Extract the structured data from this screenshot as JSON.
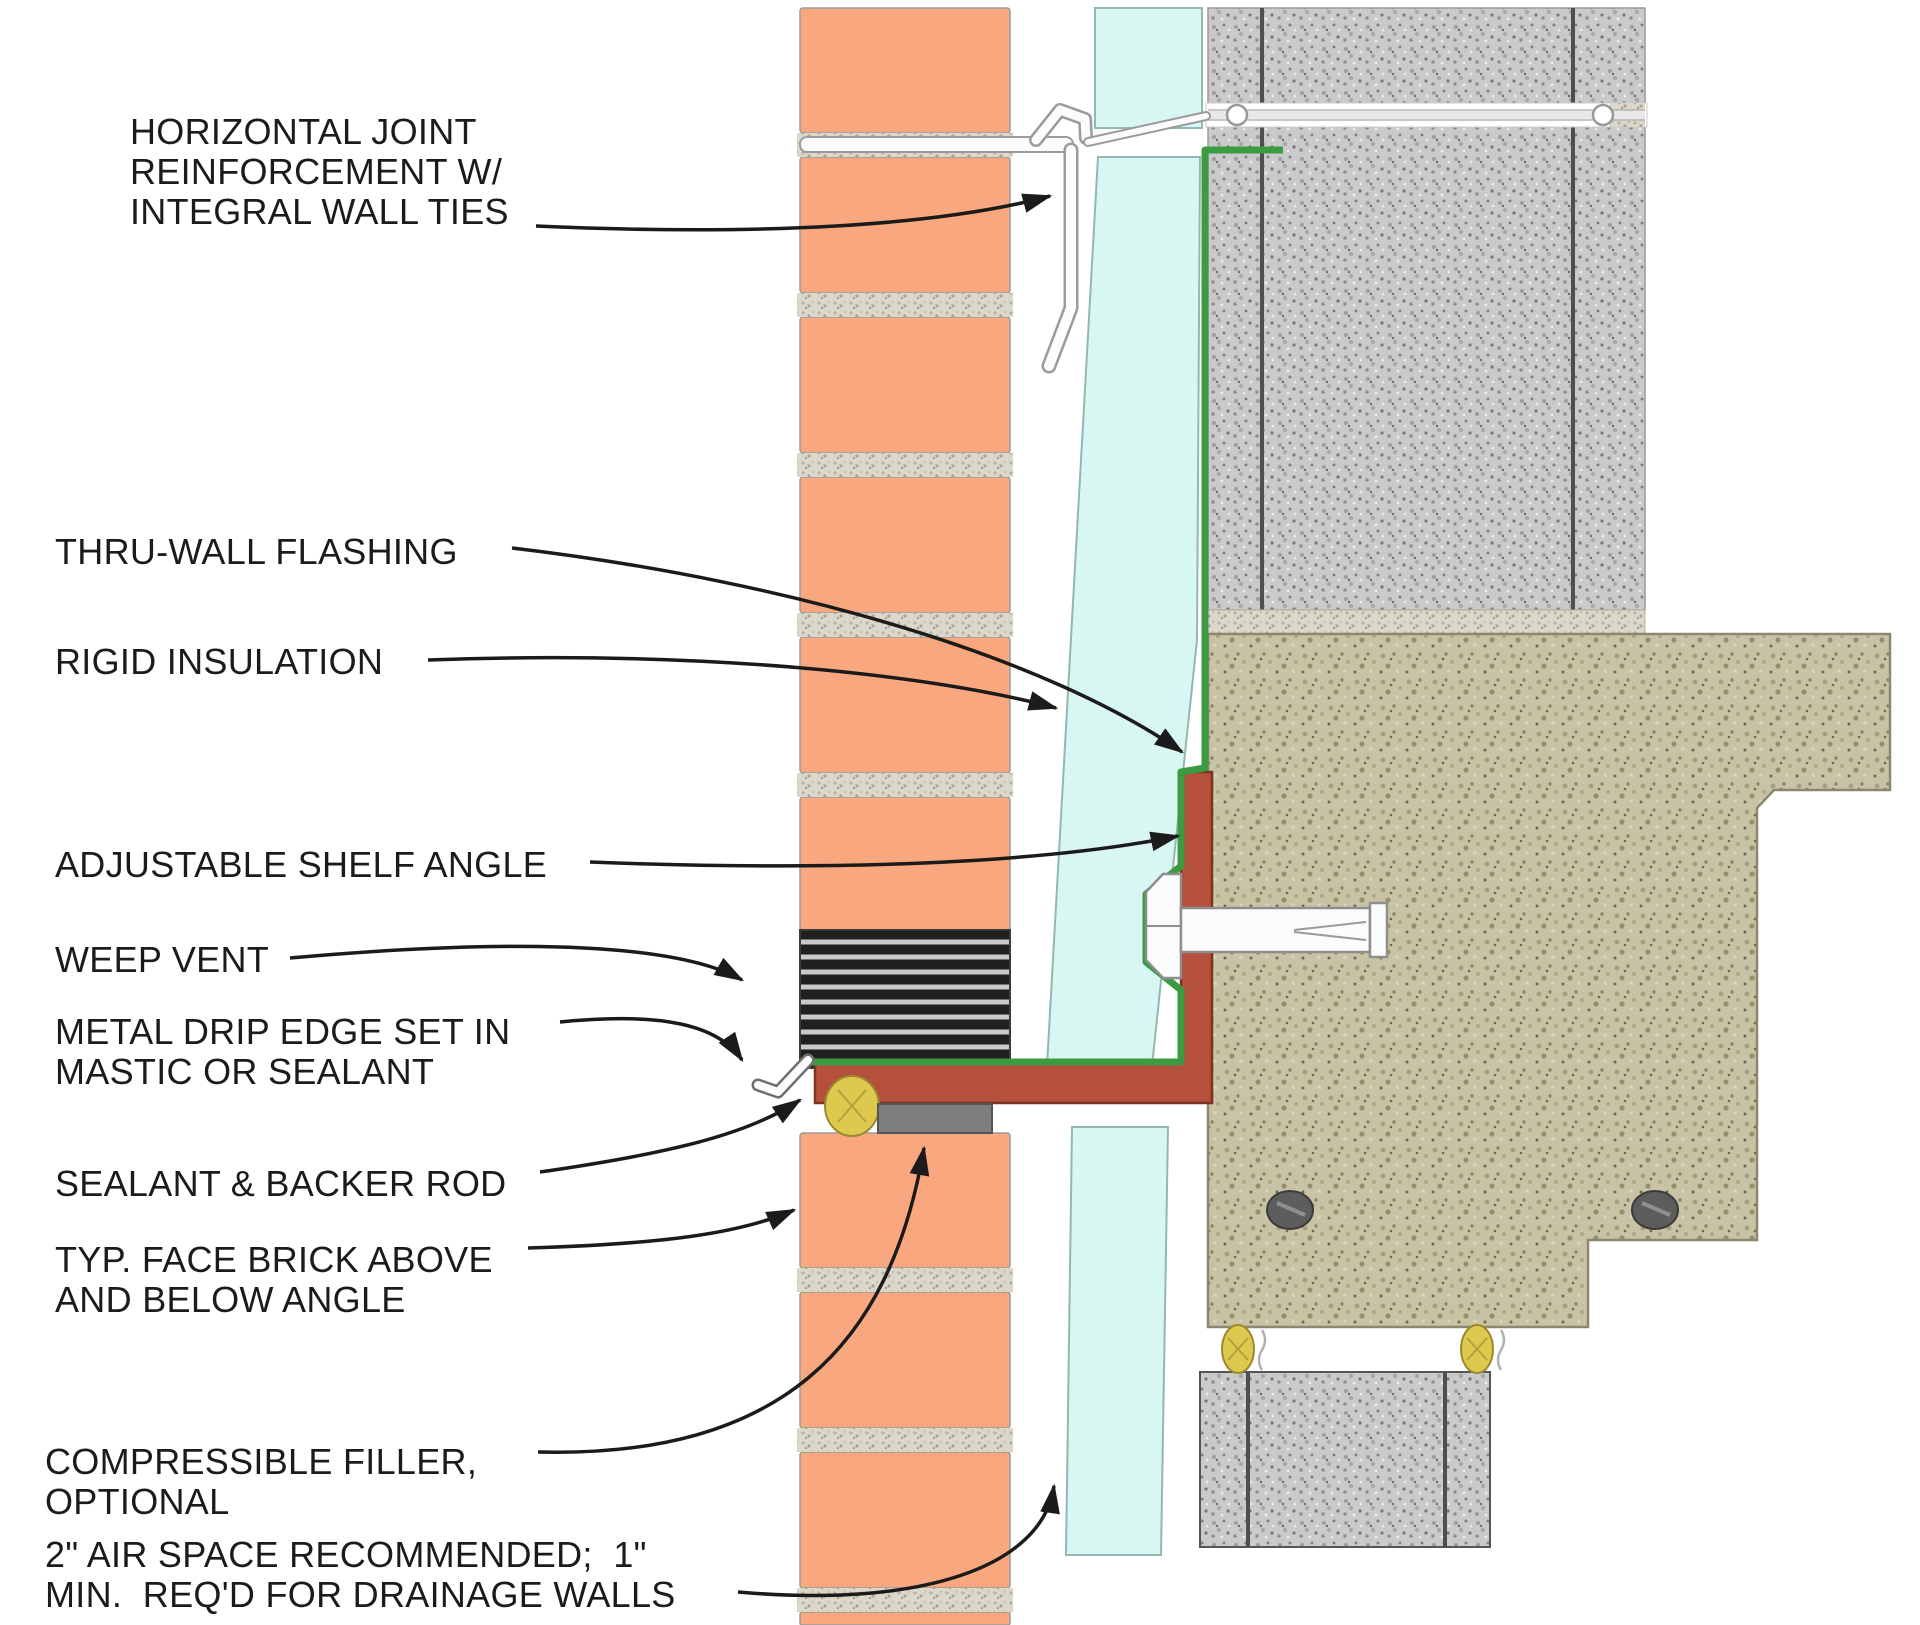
{
  "diagram": {
    "type": "architectural-detail-section",
    "subject": "Brick veneer shelf angle at concrete slab - wall section detail",
    "labels": [
      {
        "id": "horizontal-joint-reinforcement",
        "lines": [
          "HORIZONTAL JOINT",
          "REINFORCEMENT W/",
          "INTEGRAL WALL TIES"
        ]
      },
      {
        "id": "thru-wall-flashing",
        "lines": [
          "THRU-WALL FLASHING"
        ]
      },
      {
        "id": "rigid-insulation",
        "lines": [
          "RIGID INSULATION"
        ]
      },
      {
        "id": "adjustable-shelf-angle",
        "lines": [
          "ADJUSTABLE SHELF ANGLE"
        ]
      },
      {
        "id": "weep-vent",
        "lines": [
          "WEEP VENT"
        ]
      },
      {
        "id": "metal-drip-edge",
        "lines": [
          "METAL DRIP EDGE SET IN",
          "MASTIC OR SEALANT"
        ]
      },
      {
        "id": "sealant-backer-rod",
        "lines": [
          "SEALANT & BACKER ROD"
        ]
      },
      {
        "id": "typ-face-brick",
        "lines": [
          "TYP. FACE BRICK ABOVE",
          "AND BELOW ANGLE"
        ]
      },
      {
        "id": "compressible-filler",
        "lines": [
          "COMPRESSIBLE FILLER,",
          "OPTIONAL"
        ]
      },
      {
        "id": "air-space-note",
        "lines": [
          "2\" AIR SPACE RECOMMENDED;  1\"",
          "MIN.  REQ'D FOR DRAINAGE WALLS"
        ]
      }
    ],
    "materials": {
      "face_brick": {
        "name": "face brick",
        "color": "#F8A77E"
      },
      "mortar": {
        "name": "mortar joint",
        "color": "#DBD7CB"
      },
      "rigid_insulation": {
        "name": "rigid insulation",
        "color": "#D8F7F3"
      },
      "flashing": {
        "name": "thru-wall flashing",
        "color": "#3C9B40"
      },
      "shelf_angle": {
        "name": "steel shelf angle",
        "color": "#B4503B"
      },
      "weep_vent": {
        "name": "weep vent",
        "color": "#202020"
      },
      "cmu": {
        "name": "concrete masonry",
        "color": "#CACACA"
      },
      "concrete_slab": {
        "name": "concrete slab",
        "color": "#C9C3A5"
      },
      "sealant": {
        "name": "sealant",
        "color": "#DFC84E"
      },
      "compressible_filler": {
        "name": "compressible filler",
        "color": "#7E7E7E"
      },
      "metal": {
        "name": "metal / hardware",
        "color": "#FBFBFB"
      },
      "leader_line": {
        "name": "leader line",
        "color": "#1b1b1b"
      }
    }
  }
}
